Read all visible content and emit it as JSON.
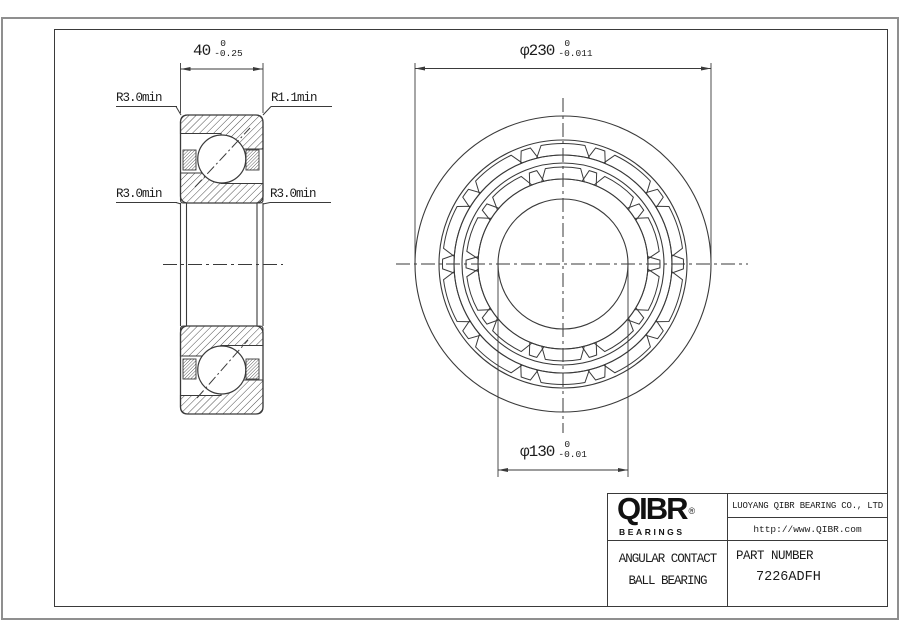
{
  "colors": {
    "line": "#3a3a3a",
    "text": "#1c1c1c",
    "sheet_border": "#8f8f8f",
    "logo": "#111111"
  },
  "title_block": {
    "logo_text": "QIBR",
    "logo_registered": "®",
    "logo_subtext": "BEARINGS",
    "company": "LUOYANG QIBR BEARING CO., LTD",
    "website": "http://www.QIBR.com",
    "product_line1": "ANGULAR CONTACT",
    "product_line2": "BALL BEARING",
    "part_number_label": "PART NUMBER",
    "part_number": "7226ADFH"
  },
  "dimensions": {
    "width": {
      "value": "40",
      "tol_upper": "0",
      "tol_lower": "-0.25"
    },
    "outer_diameter": {
      "value": "φ230",
      "tol_upper": "0",
      "tol_lower": "-0.011"
    },
    "bore_diameter": {
      "value": "φ130",
      "tol_upper": "0",
      "tol_lower": "-0.01"
    },
    "radius_top_left": "R3.0min",
    "radius_top_right": "R1.1min",
    "radius_bottom_left": "R3.0min",
    "radius_bottom_right": "R3.0min"
  },
  "geometry": {
    "left_view": {
      "x1": 180.5,
      "x2": 263,
      "top_y1": 115,
      "top_y2": 203,
      "mirror_y": 264.5,
      "corner_r": 7,
      "step_x": 221,
      "band_bot": 133.5,
      "shoulder_bot": 149,
      "inner_left_y": 173,
      "inner_right_y": 183.5,
      "ball_cx": 221.75,
      "ball_cy": 159,
      "ball_r": 24,
      "cage": {
        "y": 150,
        "h": 20,
        "lx": 183,
        "rx": 246,
        "w": 13
      },
      "bore_lines_x": [
        180.5,
        186.5,
        257,
        263
      ],
      "contact_top": [
        195,
        187,
        250,
        128
      ],
      "contact_bot": [
        197,
        398,
        248,
        340
      ],
      "centerline": [
        163,
        283
      ],
      "dim": {
        "line_y": 69,
        "ext_top": 63,
        "ext_bot": 113
      },
      "leaders": [
        [
          176,
          106.5,
          181,
          115
        ],
        [
          271,
          106.5,
          263,
          115
        ],
        [
          176,
          202.5,
          181,
          204
        ],
        [
          270,
          202.5,
          263,
          204
        ]
      ]
    },
    "right_view": {
      "cx": 563,
      "cy": 264,
      "circle_radii": [
        148,
        124,
        109,
        101,
        85,
        65
      ],
      "pocket_bands": [
        {
          "r_out": 120.5,
          "r_in": 109,
          "wide": [
            10.5,
            14
          ],
          "narrow": [
            2.3,
            4.8
          ]
        },
        {
          "r_out": 97,
          "r_in": 85,
          "wide": [
            10.5,
            14.5
          ],
          "narrow": [
            2.3,
            5
          ]
        }
      ],
      "wide_angles": [
        0,
        36,
        72,
        108,
        144,
        180,
        216,
        252,
        288,
        324
      ],
      "narrow_angles": [
        18,
        54,
        90,
        126,
        162,
        198,
        234,
        270,
        306,
        342
      ],
      "od_dim": {
        "ext_x1": 415,
        "ext_x2": 711,
        "ext_y1": 63,
        "ext_y2": 266,
        "line_y": 68.5
      },
      "bore_dim": {
        "ext_x1": 498,
        "ext_x2": 628,
        "ext_y1": 264,
        "ext_y2": 477,
        "line_y": 470
      },
      "h_centerline": [
        396,
        748
      ],
      "v_centerline": [
        98,
        433
      ]
    }
  }
}
